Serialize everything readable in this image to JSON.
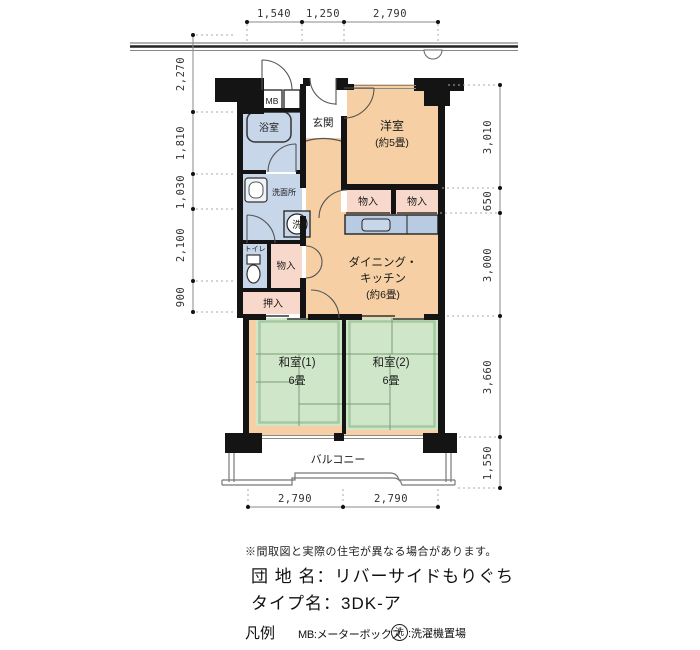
{
  "plan": {
    "rooms": {
      "western_room": {
        "name": "洋室",
        "size": "(約5畳)"
      },
      "dining_kitchen": {
        "name_line1": "ダイニング・",
        "name_line2": "キッチン",
        "size": "(約6畳)"
      },
      "japanese_room_1": {
        "name": "和室(1)",
        "size": "6畳"
      },
      "japanese_room_2": {
        "name": "和室(2)",
        "size": "6畳"
      },
      "balcony": {
        "name": "バルコニー"
      },
      "entrance": {
        "name": "玄関"
      },
      "bathroom": {
        "name": "浴室"
      },
      "washroom": {
        "name": "洗面所"
      },
      "toilet": {
        "name": "トイレ"
      },
      "meter_box": {
        "name": "MB"
      },
      "laundry_symbol": "洗",
      "closet_upper_left": "物入",
      "closet_upper_right": "物入",
      "closet_hall": "物入",
      "oshiire": "押入"
    },
    "dimensions": {
      "top": [
        "1,540",
        "1,250",
        "2,790"
      ],
      "bottom": [
        "2,790",
        "2,790"
      ],
      "left": [
        "2,270",
        "1,810",
        "1,030",
        "2,100",
        "900"
      ],
      "right": [
        "3,010",
        "650",
        "3,000",
        "3,660",
        "1,550"
      ]
    }
  },
  "title_block": {
    "note": "※間取図と実際の住宅が異なる場合があります。",
    "estate_label": "団 地 名：",
    "estate_value": "リバーサイドもりぐち",
    "type_label": "タイプ名：",
    "type_value": "3DK-ア"
  },
  "legend": {
    "heading": "凡例",
    "mb_text": "MB:メーターボックス",
    "laundry_symbol": "洗",
    "laundry_text": ":洗濯機置場"
  },
  "colors": {
    "wall": "#141414",
    "flooring": "#f6d0a4",
    "closet": "#f8d8cb",
    "wet_area": "#c8d6e9",
    "tatami": "#cfe6c8",
    "kitchen_counter": "#b9cbe3"
  }
}
